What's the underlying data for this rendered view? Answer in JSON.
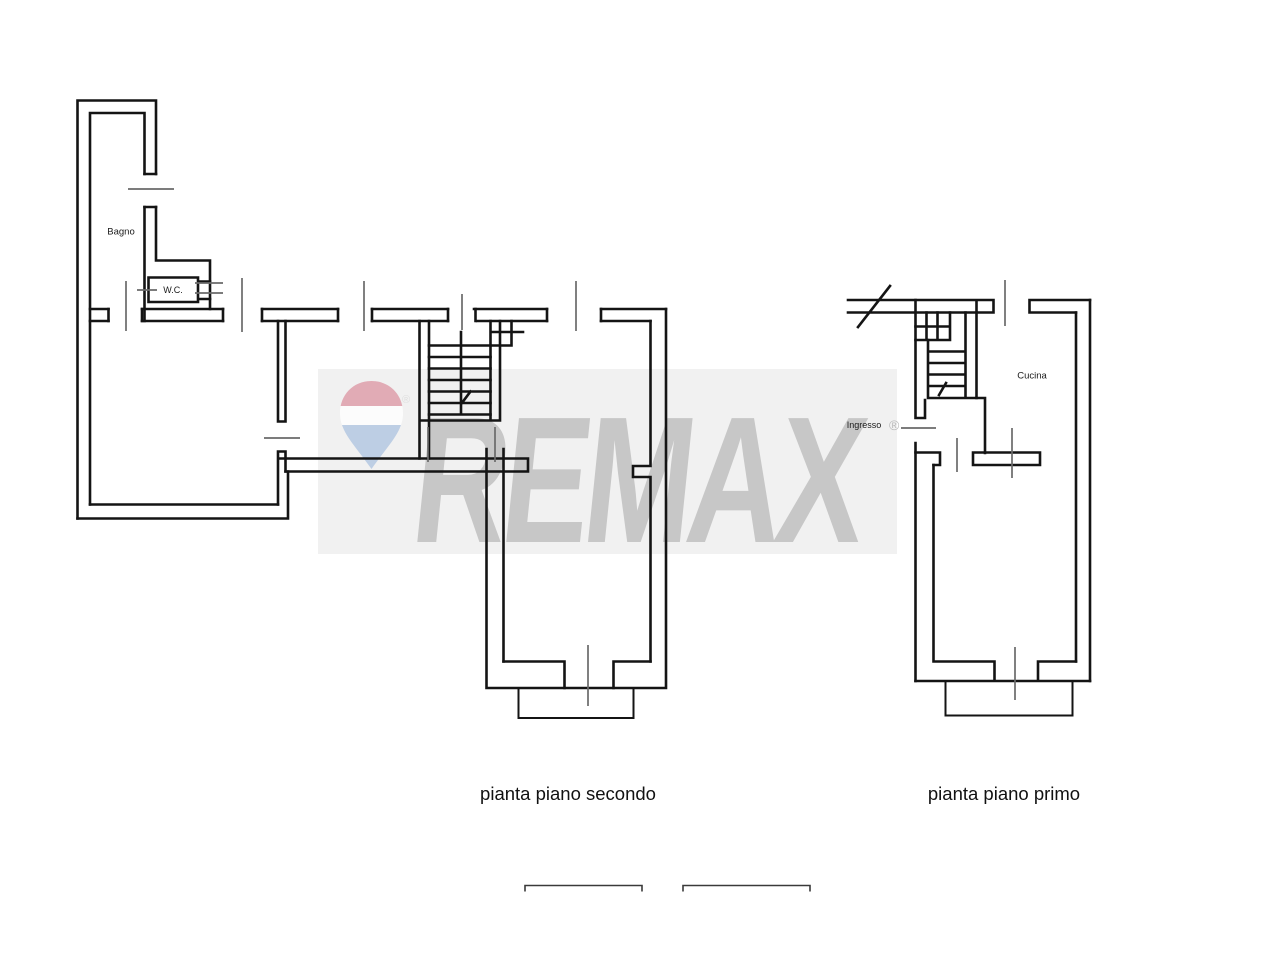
{
  "page": {
    "background": "#ffffff"
  },
  "watermark": {
    "brand": "REMAX",
    "registered_symbol": "®",
    "band_color": "#f1f1f1",
    "text_color": "#c7c7c7",
    "balloon": {
      "top_color": "#df9fab",
      "middle_color": "#ffffff",
      "bottom_color": "#b5c8e2"
    }
  },
  "floorplans": {
    "secondo": {
      "caption": "pianta piano secondo",
      "room_labels": {
        "bagno": "Bagno",
        "wc": "W.C."
      }
    },
    "primo": {
      "caption": "pianta piano primo",
      "room_labels": {
        "cucina": "Cucina",
        "ingresso": "Ingresso"
      }
    }
  },
  "scale_bars_count": 2,
  "line_colors": {
    "walls": "#141414",
    "dimension_ticks": "#6a6a6a",
    "scale_bar": "#3a3a3a"
  }
}
